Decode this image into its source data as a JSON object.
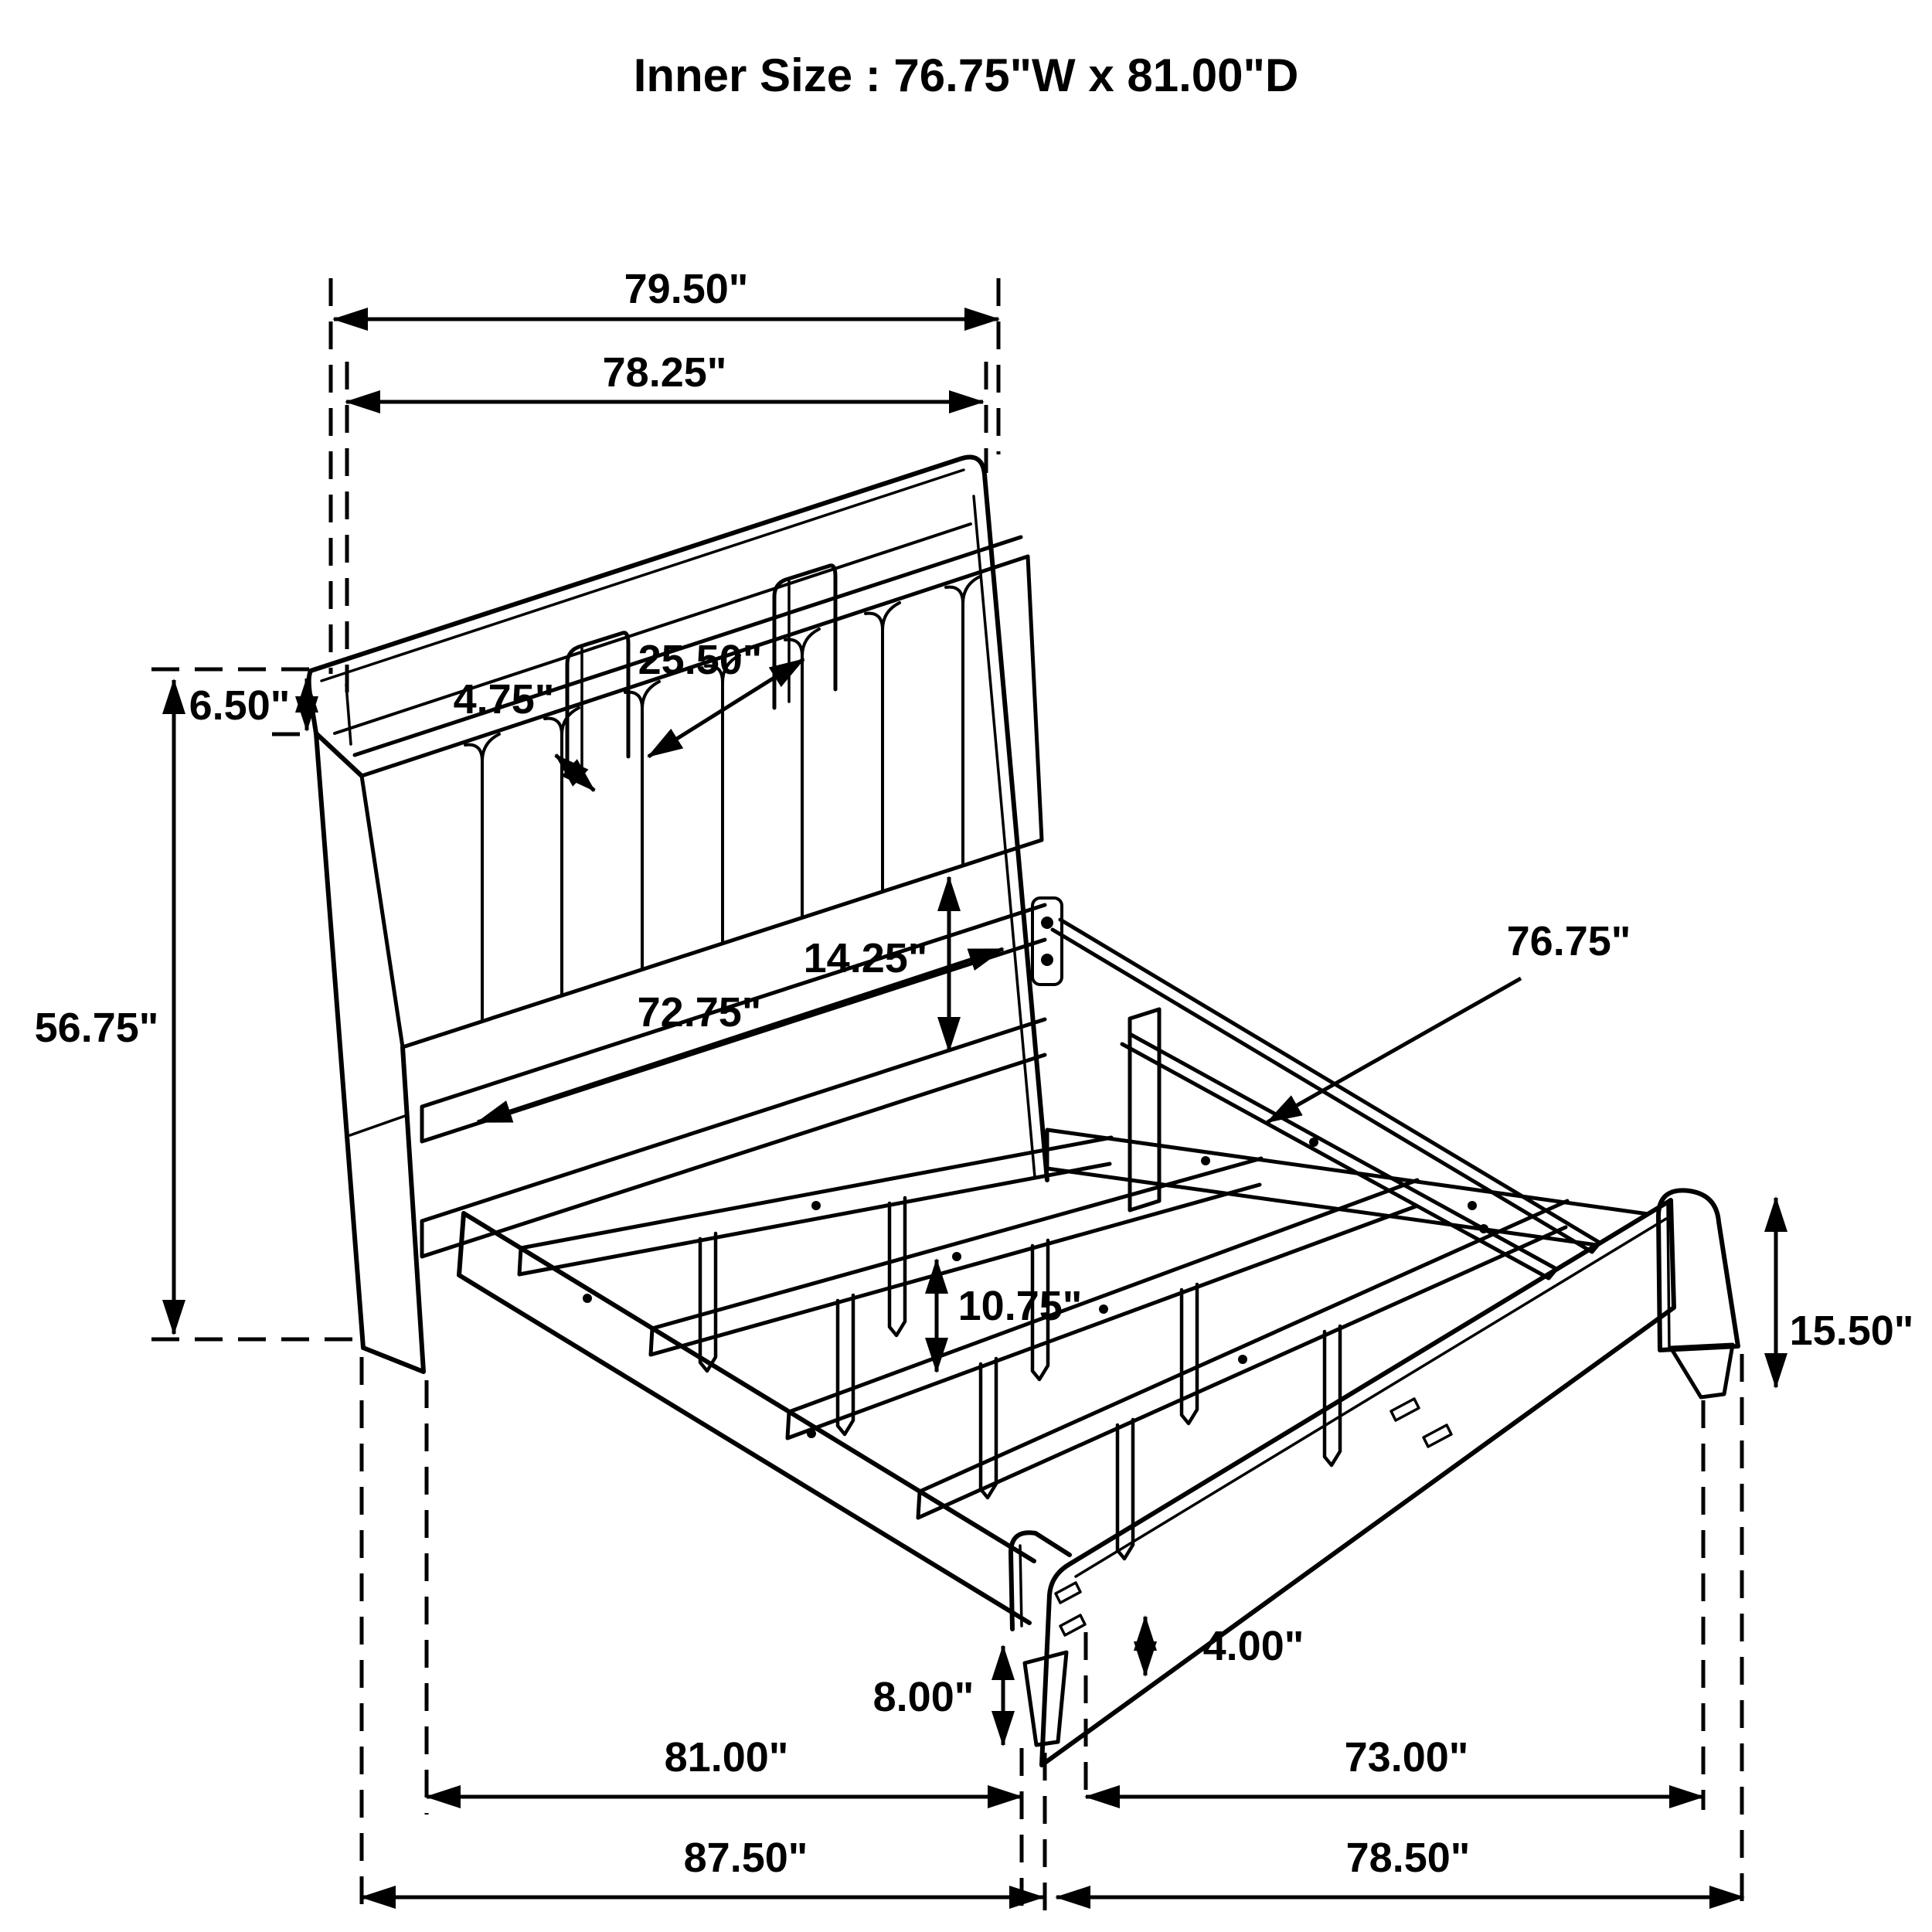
{
  "title": "Inner Size : 76.75\"W x 81.00\"D",
  "diagram": {
    "subject": "Bookcase storage bed frame - isometric dimension line drawing",
    "colors": {
      "line": "#000000",
      "background": "#ffffff"
    },
    "labels": {
      "headboard_outer_width": "79.50\"",
      "headboard_width": "78.25\"",
      "shelf_opening_width": "25.50\"",
      "shelf_divider_gap": "4.75\"",
      "shelf_height": "6.50\"",
      "headboard_height": "56.75\"",
      "panel_to_rail_height": "14.25\"",
      "headboard_inner_width": "72.75\"",
      "center_rail_length": "76.75\"",
      "footboard_height": "15.50\"",
      "support_leg_height": "10.75\"",
      "frame_clearance_height": "8.00\"",
      "footboard_leg_height": "4.00\"",
      "inner_platform_length": "81.00\"",
      "side_rail_length": "73.00\"",
      "overall_length": "87.50\"",
      "footboard_section_length": "78.50\""
    }
  }
}
